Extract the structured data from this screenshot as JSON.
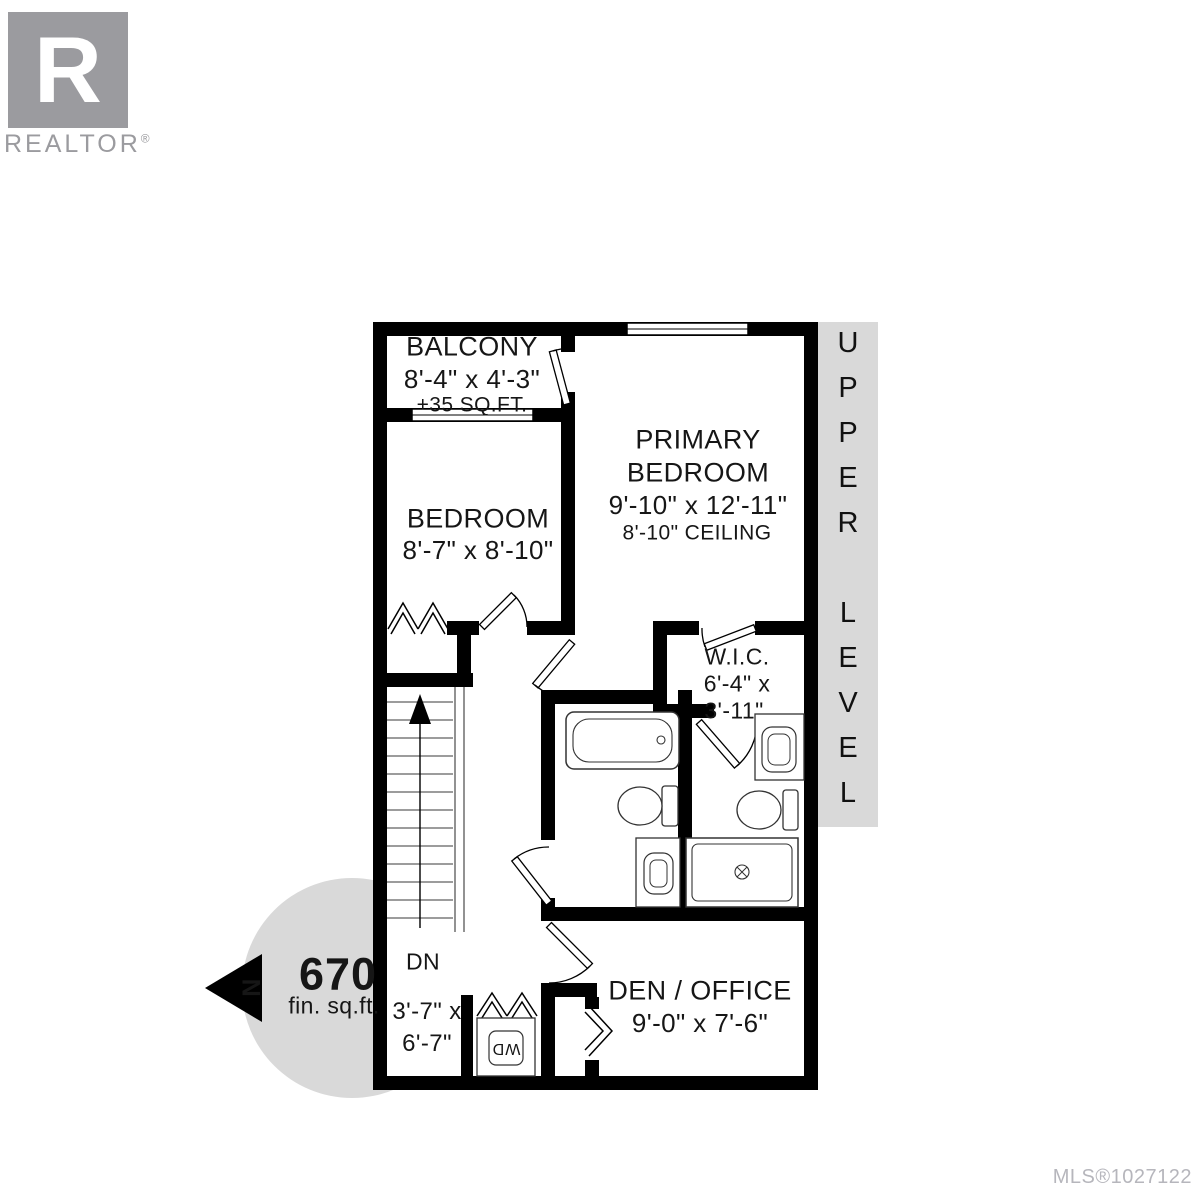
{
  "branding": {
    "logo_letter": "R",
    "logo_name": "REALTOR",
    "logo_reg": "®"
  },
  "footer": {
    "mls": "MLS®1027122"
  },
  "level_banner": "UPPER LEVEL",
  "north_letter": "N",
  "area_badge": {
    "value": "670",
    "unit": "fin. sq.ft."
  },
  "rooms": {
    "balcony": {
      "name": "BALCONY",
      "dims": "8'-4\" x 4'-3\"",
      "note": "+35 SQ.FT."
    },
    "primary_bedroom": {
      "name_line1": "PRIMARY",
      "name_line2": "BEDROOM",
      "dims": "9'-10\" x 12'-11\"",
      "ceiling": "8'-10\" CEILING"
    },
    "bedroom": {
      "name": "BEDROOM",
      "dims": "8'-7\" x 8'-10\""
    },
    "wic": {
      "name": "W.I.C.",
      "dims_line1": "6'-4\" x",
      "dims_line2": "3'-11\""
    },
    "den_office": {
      "name": "DEN / OFFICE",
      "dims": "9'-0\" x 7'-6\""
    },
    "hallway": {
      "dims_line1": "3'-7\" x",
      "dims_line2": "6'-7\""
    },
    "stairs": {
      "direction": "DN"
    },
    "laundry": {
      "unit": "WD"
    }
  },
  "colors": {
    "wall": "#000000",
    "panel_gray": "#d9d9d9",
    "logo_gray": "#9b9b9f",
    "mls_gray": "#b6b6bc"
  }
}
